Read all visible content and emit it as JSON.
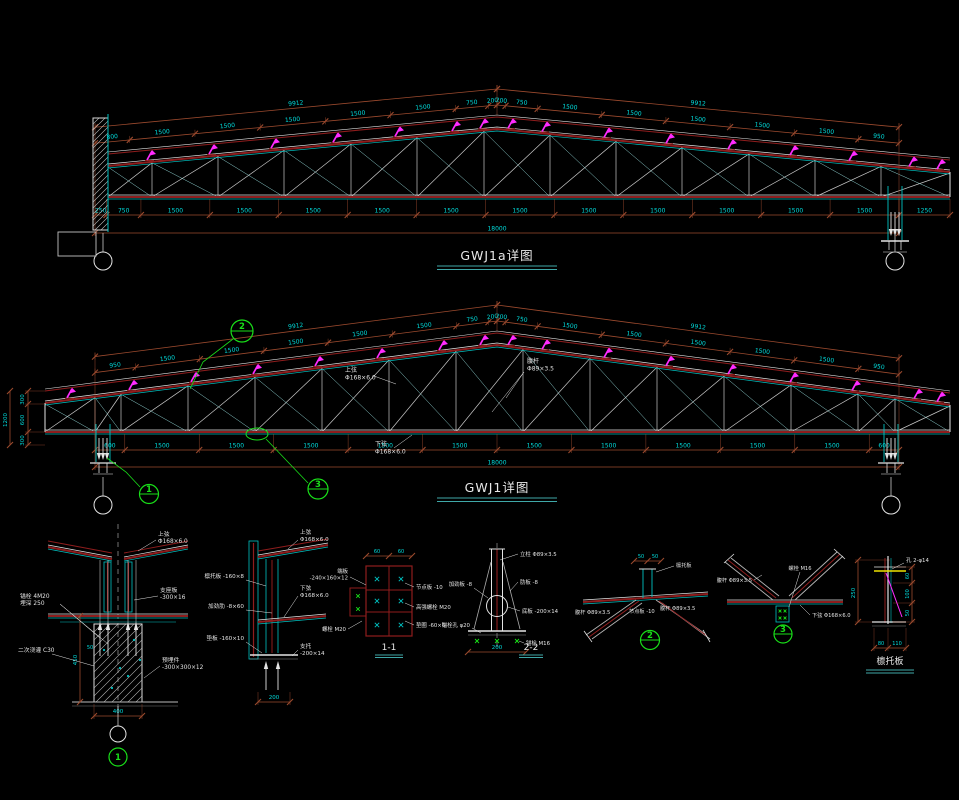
{
  "drawing_titles": {
    "truss_a": "GWJ1a详图",
    "truss_b": "GWJ1详图"
  },
  "truss_a": {
    "ridge_dim_left": "9912",
    "ridge_dim_right": "9912",
    "upper_segments_left": [
      "800",
      "1500",
      "1500",
      "1500",
      "1500",
      "1500",
      "750",
      "200"
    ],
    "upper_segments_right": [
      "200",
      "750",
      "1500",
      "1500",
      "1500",
      "1500",
      "1500",
      "950"
    ],
    "lower_segments": [
      "250",
      "750",
      "1500",
      "1500",
      "1500",
      "1500",
      "1500",
      "1500",
      "1500",
      "1500",
      "1500",
      "1500",
      "1500"
    ],
    "lower_tail": "1250",
    "total": "18000"
  },
  "truss_b": {
    "ridge_dim_left": "9912",
    "ridge_dim_right": "9912",
    "upper_segments_left": [
      "950",
      "1500",
      "1500",
      "1500",
      "1500",
      "1500",
      "750",
      "200"
    ],
    "upper_segments_right": [
      "200",
      "750",
      "1500",
      "1500",
      "1500",
      "1500",
      "1500",
      "950"
    ],
    "lower_segments": [
      "600",
      "1500",
      "1500",
      "1500",
      "1500",
      "1500",
      "1500",
      "1500",
      "1500",
      "1500",
      "1500",
      "600"
    ],
    "total": "18000",
    "left_segments": [
      "300",
      "600",
      "300"
    ],
    "left_total": "1200",
    "top_chord_label": [
      "上弦",
      "Φ168×6.0"
    ],
    "web_label": [
      "腹杆",
      "Φ89×3.5"
    ],
    "bottom_chord_label": [
      "下弦",
      "Φ168×6.0"
    ],
    "callout_1": "1",
    "callout_2": "2",
    "callout_3": "3"
  },
  "details": {
    "d1": {
      "callout": "1",
      "right_labels": [
        [
          "上弦",
          "Φ168×6.0"
        ],
        [
          "支座板",
          "-300×16"
        ],
        [
          "预埋件",
          "-300×300×12"
        ]
      ],
      "left_labels": [
        [
          "锚栓 4M20",
          "埋深 250"
        ],
        [
          "二次浇灌 C30"
        ]
      ],
      "dims": [
        "50",
        "450",
        "400"
      ]
    },
    "d2": {
      "left_labels": [
        "檩托板 -160×8",
        "加劲肋 -8×60",
        "垫板 -160×10"
      ],
      "right_labels": [
        [
          "上弦",
          "Φ168×6.0"
        ],
        [
          "下弦",
          "Φ168×6.0"
        ],
        [
          "支托",
          "-200×14"
        ]
      ],
      "dims": [
        "200"
      ]
    },
    "d11": {
      "title": "1-1",
      "left_labels": [
        [
          "端板",
          "-240×160×12"
        ],
        [
          "螺栓 M20"
        ]
      ],
      "right_labels": [
        "节点板 -10",
        "高强螺栓 M20",
        "垫圈 -60×6"
      ],
      "dims": [
        "60",
        "60"
      ]
    },
    "d22": {
      "title": "2-2",
      "left_labels": [
        "加劲板 -8",
        "锚栓孔 φ20"
      ],
      "right_labels": [
        "立柱 Φ89×3.5",
        "肋板 -8",
        "底板 -200×14",
        "锚栓 M16"
      ],
      "dims": [
        "200"
      ]
    },
    "d5": {
      "callout": "2",
      "labels": [
        "腹杆 Φ89×3.5",
        "节点板 -10",
        "腹杆 Φ89×3.5",
        "檩托板"
      ],
      "dims": [
        "50",
        "50"
      ]
    },
    "d6": {
      "callout": "3",
      "labels": [
        "腹杆 Φ89×3.5",
        "螺栓 M16",
        "下弦 Φ168×6.0"
      ]
    },
    "d7": {
      "title": "檩托板",
      "top_label": "孔 2-φ14",
      "dims": [
        "250",
        "60",
        "100",
        "50",
        "80",
        "110"
      ]
    }
  },
  "colors": {
    "background": "#000000",
    "dim_line": "#9c4a2e",
    "dim_text": "#00dcdc",
    "chord_red": "#8f1d1d",
    "member_gray": "#c8c8c8",
    "member_cyan": "#00c2c2",
    "purlin_magenta": "#ff2bff",
    "callout_green": "#19e019",
    "line_white": "#e4e4e4",
    "detail_yellow": "#f0e400",
    "title_underline": "#3fa8a8"
  }
}
